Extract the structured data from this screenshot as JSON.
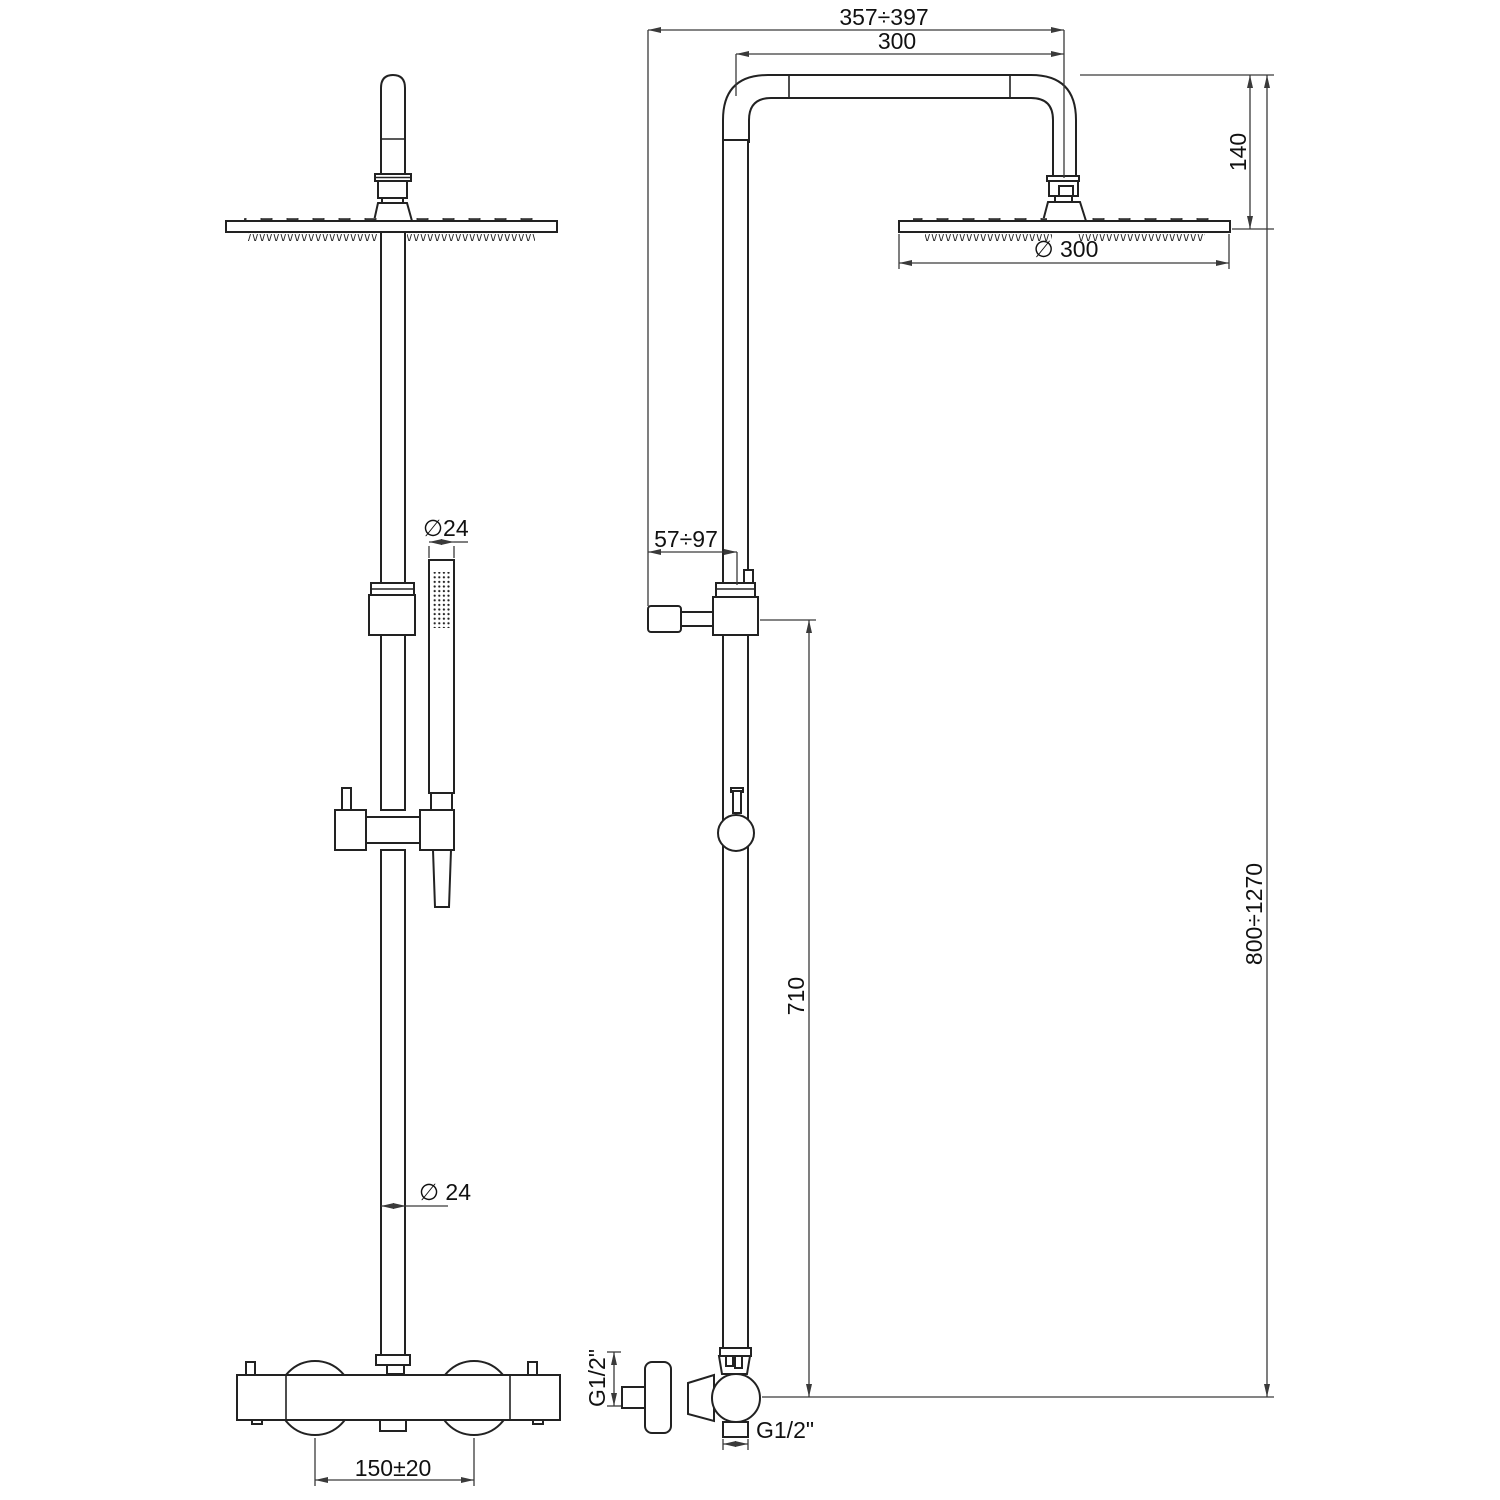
{
  "drawing": {
    "title": "Thermostatic shower column technical drawing",
    "views": [
      {
        "id": "front",
        "label": "front view"
      },
      {
        "id": "side",
        "label": "side view"
      }
    ],
    "style": {
      "line_color": "#222222",
      "dim_color": "#3a3a3a",
      "background": "#ffffff"
    }
  },
  "dimensions": {
    "arm_reach_range": "357÷397",
    "arm_length": "300",
    "head_drop": "140",
    "head_diameter": "∅ 300",
    "wall_distance_range": "57÷97",
    "handshower_diameter": "∅24",
    "riser_diameter": "∅ 24",
    "outlet_to_slider_height": "710",
    "column_height_range": "800÷1270",
    "inlet_centers": "150±20",
    "side_inlet_thread": "G1/2\"",
    "bottom_outlet_thread": "G1/2\""
  }
}
